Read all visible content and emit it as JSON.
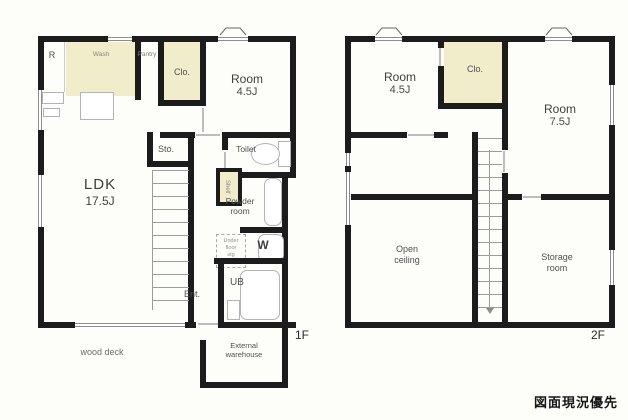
{
  "stamp": "図面現況優先",
  "f1": {
    "floor": "1F",
    "ldk": "LDK",
    "ldk_size": "17.5J",
    "room": "Room",
    "room_size": "4.5J",
    "fridge": "R",
    "kitchen": "Wash",
    "pantry": "Pantry",
    "closet": "Clo.",
    "sto": "Sto.",
    "toilet": "Toilet",
    "powder1": "Powder",
    "powder2": "room",
    "shelf": "Shelf",
    "uf1": "Under",
    "uf2": "floor",
    "uf3": "stg",
    "washer": "W",
    "bath": "UB",
    "ent": "Ent.",
    "wood_deck": "wood deck",
    "wh1": "External",
    "wh2": "warehouse"
  },
  "f2": {
    "floor": "2F",
    "room1": "Room",
    "room1_size": "4.5J",
    "closet": "Clo.",
    "room2": "Room",
    "room2_size": "7.5J",
    "open1": "Open",
    "open2": "ceiling",
    "sto1": "Storage",
    "sto2": "room"
  },
  "colors": {
    "wall": "#1c1c1c",
    "storage_fill": "#f1ecca",
    "paper": "#fdfdf9"
  }
}
